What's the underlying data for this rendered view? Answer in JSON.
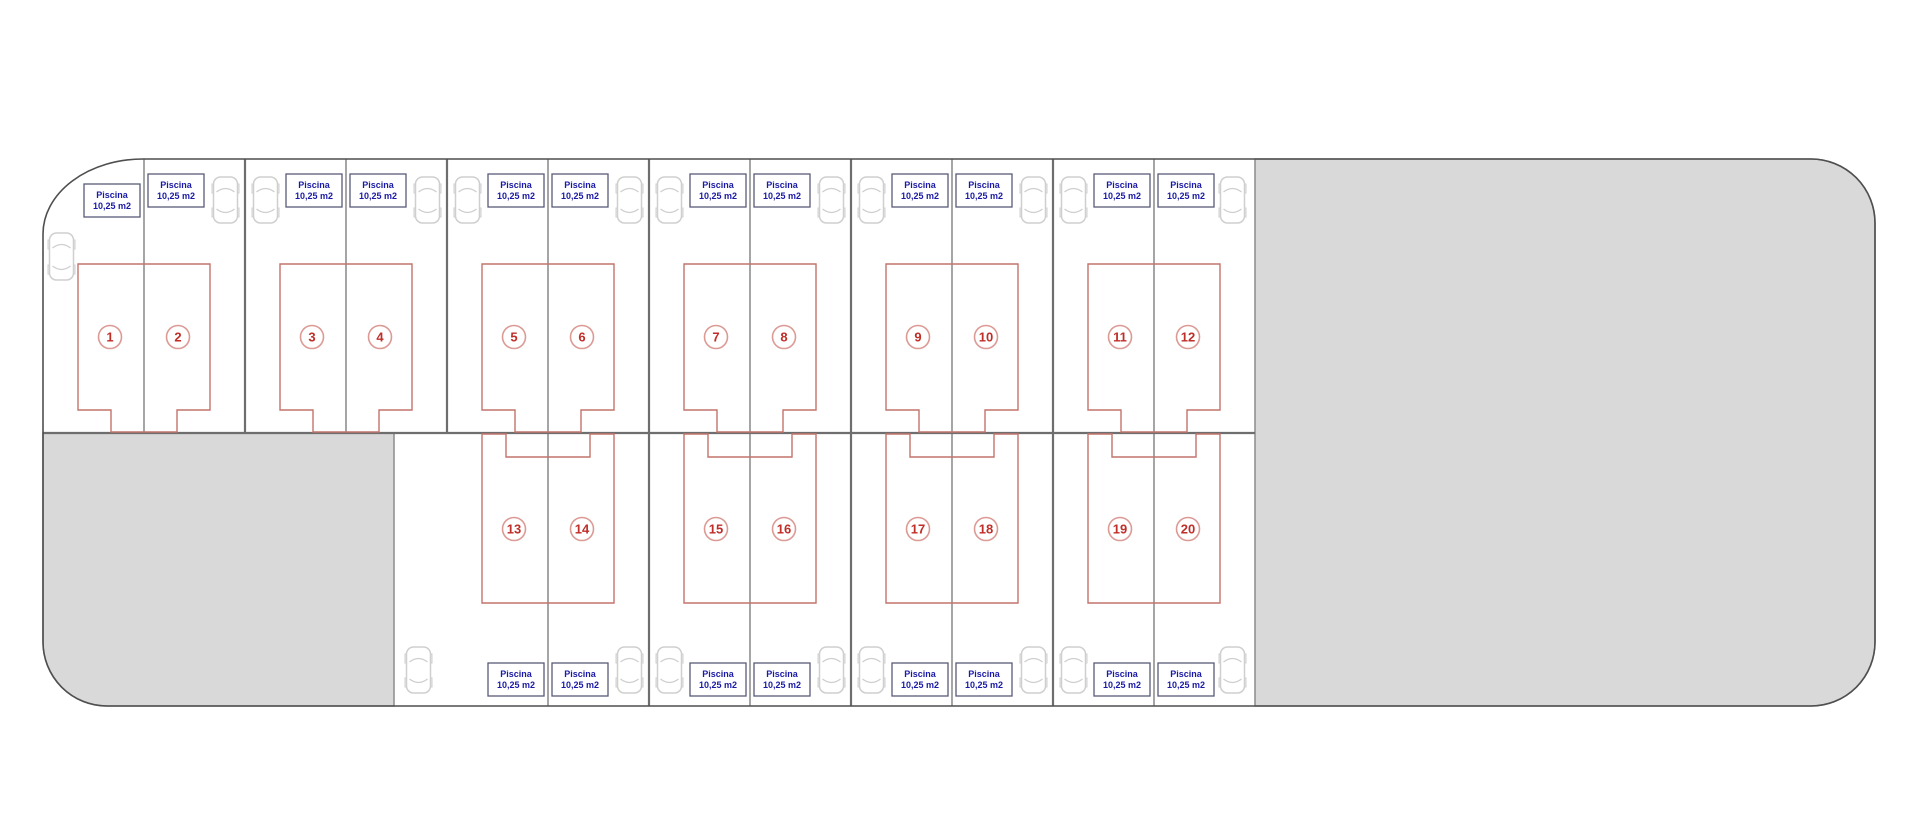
{
  "plan": {
    "pool_label": {
      "line1": "Piscina",
      "line2": "10,25 m2"
    },
    "rows": {
      "top": {
        "units": [
          "1",
          "2",
          "3",
          "4",
          "5",
          "6",
          "7",
          "8",
          "9",
          "10",
          "11",
          "12"
        ]
      },
      "bottom": {
        "units": [
          "13",
          "14",
          "15",
          "16",
          "17",
          "18",
          "19",
          "20"
        ]
      }
    },
    "colors": {
      "background": "#ffffff",
      "site_outline": "#4f4f4f",
      "parcel_line": "#7f7f7f",
      "block_line": "#6e6e6e",
      "grey_fill": "#d9d9d9",
      "grey_border": "#8c8c8c",
      "house_outline": "#c4736c",
      "unit_number": "#c02e28",
      "unit_circle_stroke": "#dc9a95",
      "pool_box_border": "#5a5a78",
      "pool_text": "#1a1aa6",
      "car_outline": "#cfcfcf"
    }
  }
}
